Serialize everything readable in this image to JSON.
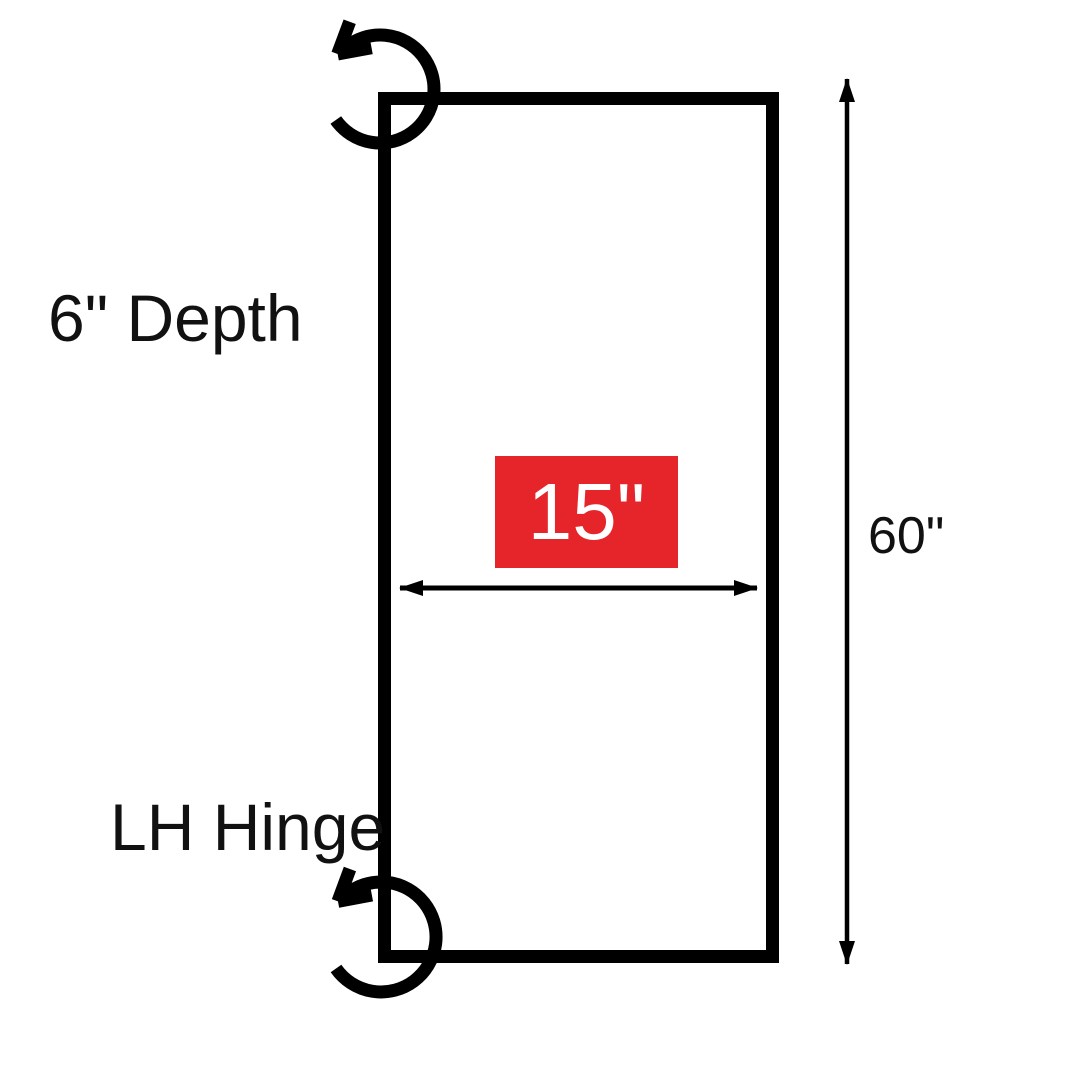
{
  "diagram": {
    "subject": "cabinet-door-dimension-diagram",
    "background_color": "#FFFFFF",
    "line_color": "#000000",
    "labels": {
      "depth": "6\" Depth",
      "hinge": "LH Hinge"
    },
    "dimensions": {
      "width": {
        "value": "15\"",
        "badge_bg_color": "#E6252B",
        "badge_text_color": "#FFFFFF"
      },
      "height": {
        "value": "60\""
      }
    },
    "icons": {
      "top_corner": "counterclockwise-rotation-arrow",
      "bottom_corner": "counterclockwise-rotation-arrow"
    }
  }
}
